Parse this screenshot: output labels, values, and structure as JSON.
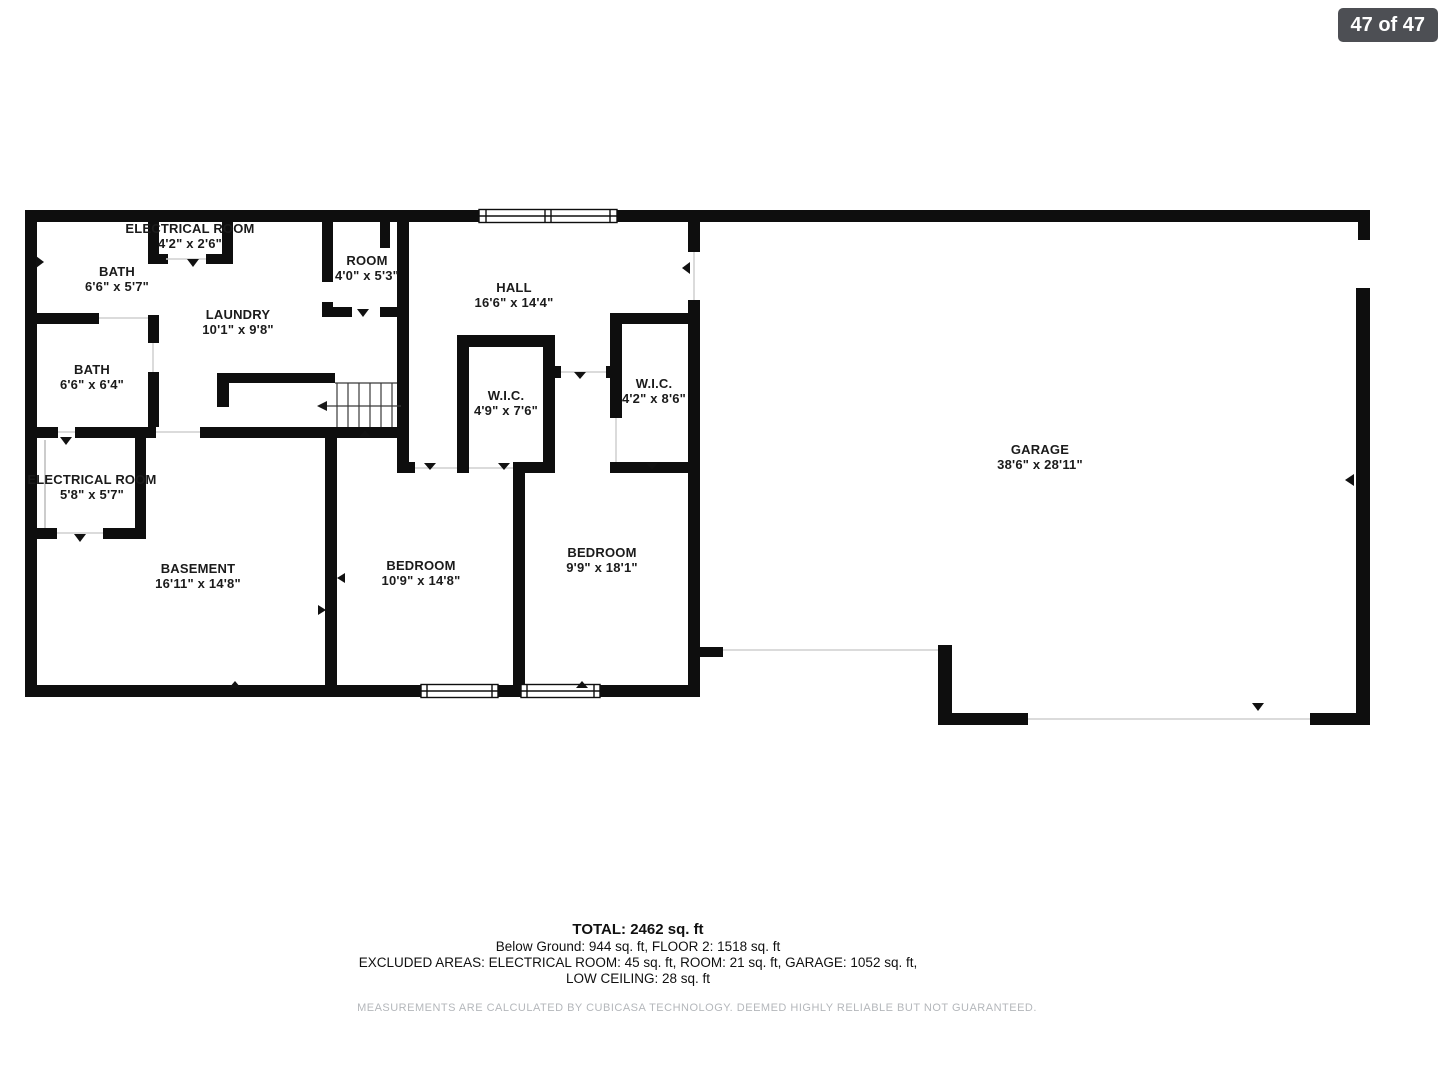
{
  "viewer": {
    "page_indicator": "47 of 47"
  },
  "colors": {
    "wall": "#0e0e0e",
    "badge_bg": "#4d4f54",
    "badge_text": "#ffffff",
    "disclaimer_text": "#b4b7bb"
  },
  "floorplan": {
    "rooms": [
      {
        "id": "electrical-room-upper",
        "name": "ELECTRICAL ROOM",
        "dims": "4'2\" x 2'6\""
      },
      {
        "id": "bath-upper",
        "name": "BATH",
        "dims": "6'6\" x 5'7\""
      },
      {
        "id": "room",
        "name": "ROOM",
        "dims": "4'0\" x 5'3\""
      },
      {
        "id": "hall",
        "name": "HALL",
        "dims": "16'6\" x 14'4\""
      },
      {
        "id": "laundry",
        "name": "LAUNDRY",
        "dims": "10'1\" x 9'8\""
      },
      {
        "id": "bath-lower",
        "name": "BATH",
        "dims": "6'6\" x 6'4\""
      },
      {
        "id": "wic-1",
        "name": "W.I.C.",
        "dims": "4'9\" x 7'6\""
      },
      {
        "id": "wic-2",
        "name": "W.I.C.",
        "dims": "4'2\" x 8'6\""
      },
      {
        "id": "garage",
        "name": "GARAGE",
        "dims": "38'6\" x 28'11\""
      },
      {
        "id": "electrical-room-lower",
        "name": "ELECTRICAL ROOM",
        "dims": "5'8\" x 5'7\""
      },
      {
        "id": "basement",
        "name": "BASEMENT",
        "dims": "16'11\" x 14'8\""
      },
      {
        "id": "bedroom-1",
        "name": "BEDROOM",
        "dims": "10'9\" x 14'8\""
      },
      {
        "id": "bedroom-2",
        "name": "BEDROOM",
        "dims": "9'9\" x 18'1\""
      }
    ],
    "summary": {
      "total": "TOTAL: 2462 sq. ft",
      "line2": "Below Ground: 944 sq. ft, FLOOR 2: 1518 sq. ft",
      "line3": "EXCLUDED AREAS: ELECTRICAL ROOM: 45 sq. ft, ROOM: 21 sq. ft, GARAGE: 1052 sq. ft,",
      "line4": "LOW CEILING: 28 sq. ft",
      "disclaimer": "MEASUREMENTS ARE CALCULATED BY CUBICASA TECHNOLOGY. DEEMED HIGHLY RELIABLE BUT NOT GUARANTEED."
    }
  }
}
